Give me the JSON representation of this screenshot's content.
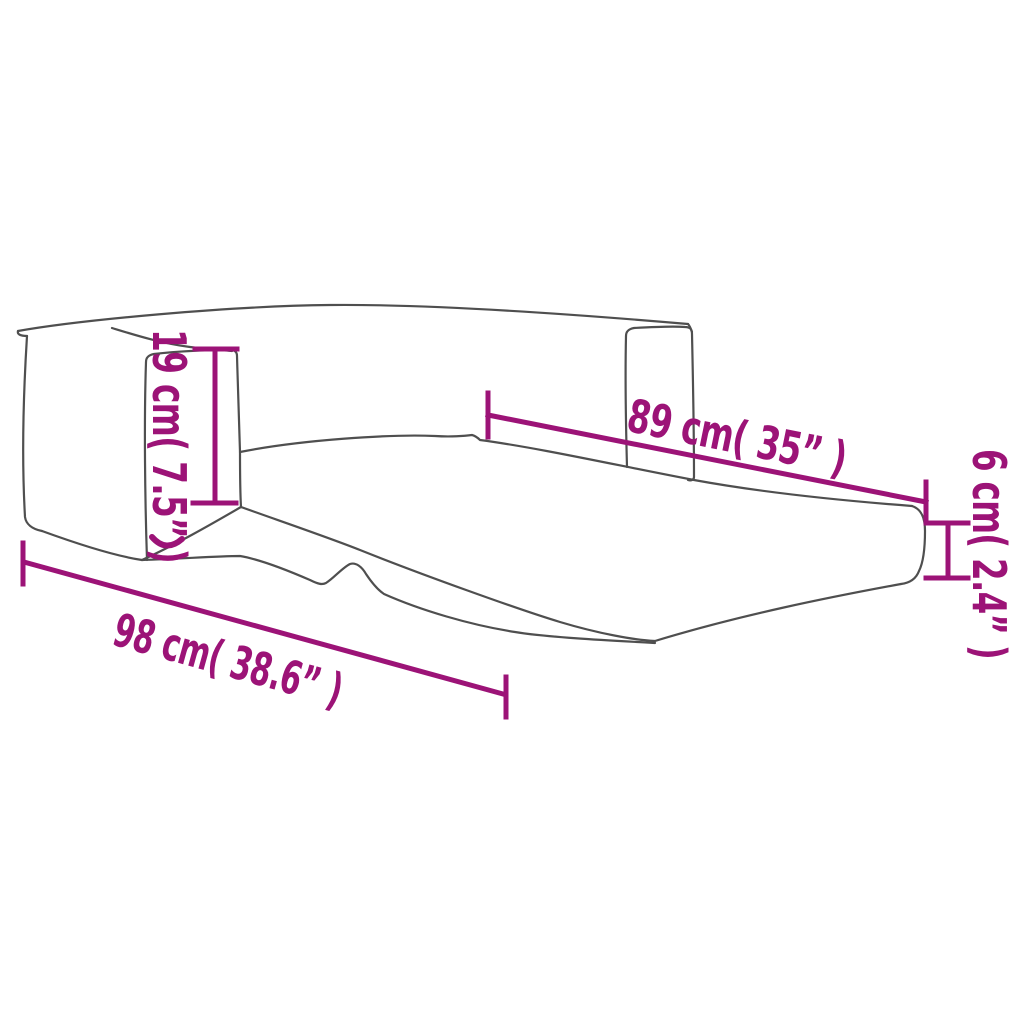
{
  "image": {
    "description": "Dimension diagram line drawing of a 2-in-1 fold-out kids sofa opened into a lounger",
    "background_color": "#ffffff",
    "accent_color": "#9C1377",
    "outline_color": "#4f4f4f"
  },
  "dimensions": {
    "armrest_height": {
      "label": "19 cm( 7.5” )",
      "cm": 19,
      "inches": 7.5,
      "orientation": "vertical-left"
    },
    "inner_length": {
      "label": "89 cm( 35” )",
      "cm": 89,
      "inches": 35,
      "orientation": "diagonal-upper-right"
    },
    "mattress_thickness": {
      "label": "6 cm( 2.4” )",
      "cm": 6,
      "inches": 2.4,
      "orientation": "vertical-right"
    },
    "total_length": {
      "label": "98 cm( 38.6” )",
      "cm": 98,
      "inches": 38.6,
      "orientation": "diagonal-lower-left"
    }
  }
}
